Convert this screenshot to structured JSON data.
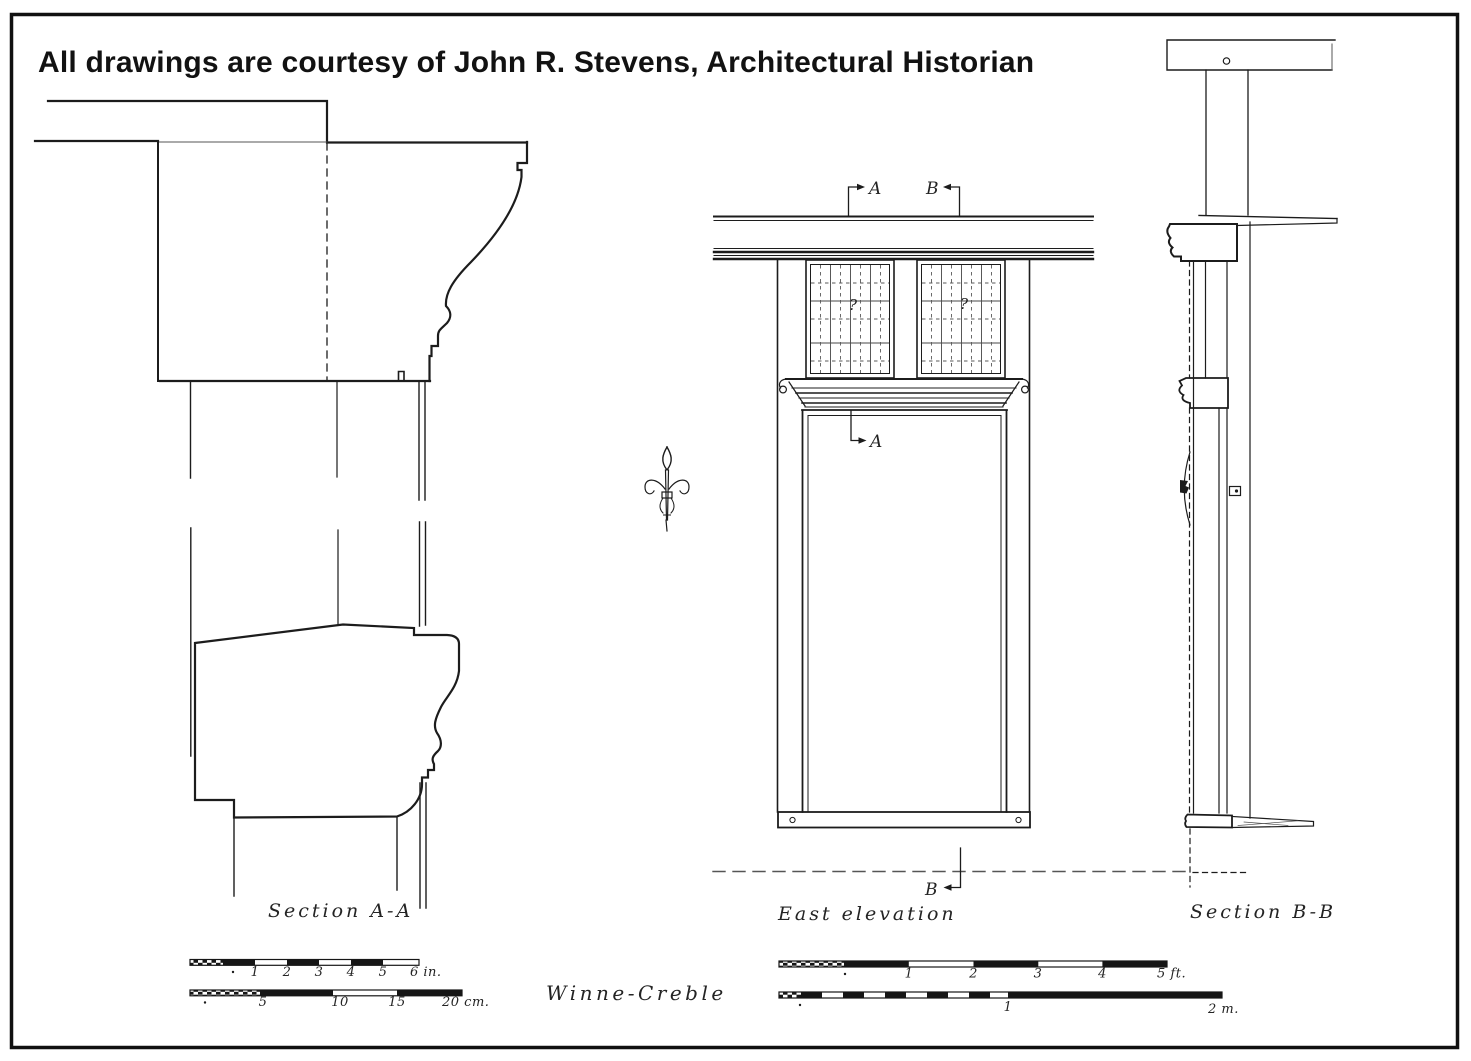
{
  "title": "All drawings are courtesy of John R. Stevens, Architectural Historian",
  "drawings": {
    "section_a": {
      "label": "Section A-A"
    },
    "east_elevation": {
      "label": "East elevation",
      "marker_a": "A",
      "marker_b": "B",
      "glazing_note": "?"
    },
    "section_b": {
      "label": "Section B-B"
    }
  },
  "credit": "Winne-Creble",
  "scale_bars": {
    "inches": {
      "ticks": [
        "1",
        "2",
        "3",
        "4",
        "5"
      ],
      "end_label": "6 in."
    },
    "centimeters": {
      "ticks": [
        "5",
        "10",
        "15"
      ],
      "end_label": "20 cm."
    },
    "feet": {
      "ticks": [
        "1",
        "2",
        "3",
        "4"
      ],
      "end_label": "5 ft."
    },
    "meters": {
      "ticks": [
        "1"
      ],
      "end_label": "2 m."
    }
  },
  "colors": {
    "ink": "#1c1c1c",
    "paper": "#ffffff"
  }
}
